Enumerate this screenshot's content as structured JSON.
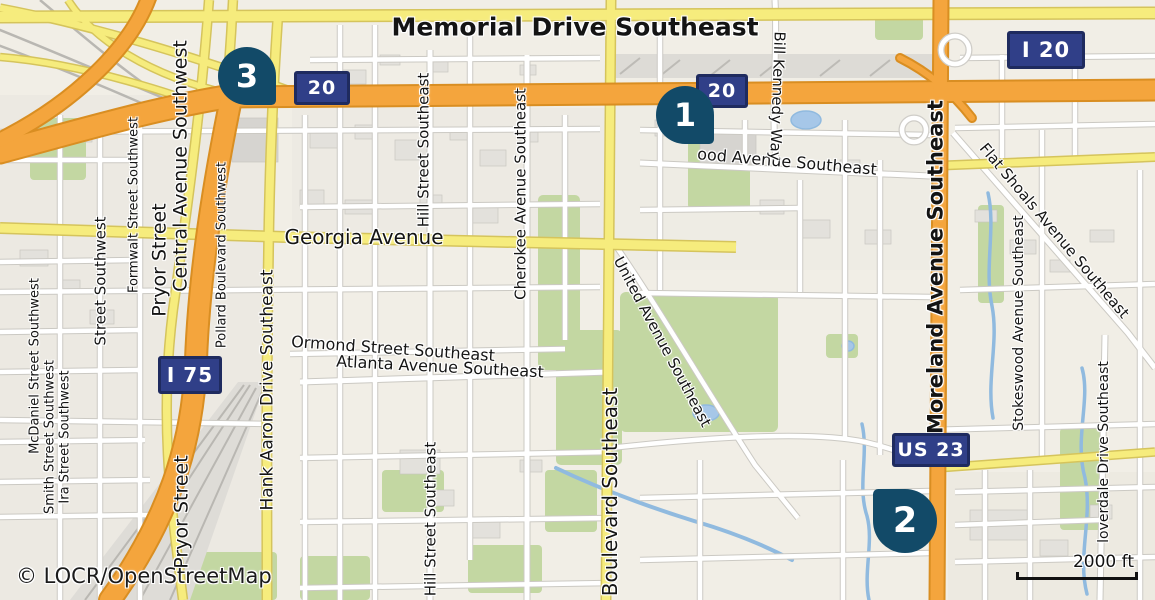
{
  "map": {
    "attribution": "© LOCR/OpenStreetMap",
    "scale_bar": {
      "label": "2000 ft"
    },
    "markers": [
      {
        "number": "1",
        "x": 685,
        "y": 115,
        "size": 58,
        "tail": "br"
      },
      {
        "number": "2",
        "x": 905,
        "y": 521,
        "size": 64,
        "tail": "tl"
      },
      {
        "number": "3",
        "x": 247,
        "y": 76,
        "size": 58,
        "tail": "br"
      }
    ],
    "shields": [
      {
        "text": "20",
        "x": 322,
        "y": 88,
        "w": 56,
        "h": 34,
        "fs": 19
      },
      {
        "text": "20",
        "x": 722,
        "y": 91,
        "w": 52,
        "h": 34,
        "fs": 19
      },
      {
        "text": "I 20",
        "x": 1046,
        "y": 50,
        "w": 78,
        "h": 38,
        "fs": 21
      },
      {
        "text": "I 75",
        "x": 190,
        "y": 375,
        "w": 64,
        "h": 38,
        "fs": 20
      },
      {
        "text": "US 23",
        "x": 931,
        "y": 450,
        "w": 78,
        "h": 34,
        "fs": 19
      }
    ],
    "street_labels": [
      {
        "text": "Memorial Drive Southeast",
        "x": 575,
        "y": 27,
        "size": 25,
        "bold": true,
        "rot": 0
      },
      {
        "text": "Georgia Avenue",
        "x": 364,
        "y": 237,
        "size": 20,
        "bold": false,
        "rot": 0
      },
      {
        "text": "Ormond Street Southeast",
        "x": 393,
        "y": 349,
        "size": 16,
        "bold": false,
        "rot": 4
      },
      {
        "text": "Atlanta Avenue Southeast",
        "x": 440,
        "y": 367,
        "size": 16,
        "bold": false,
        "rot": 3
      },
      {
        "text": "ood Avenue Southeast",
        "x": 787,
        "y": 162,
        "size": 16,
        "bold": false,
        "rot": 5
      },
      {
        "text": "Bill Kennedy Way",
        "x": 777,
        "y": 96,
        "size": 15,
        "bold": false,
        "rot": 92
      },
      {
        "text": "United Avenue Southeast",
        "x": 662,
        "y": 342,
        "size": 15,
        "bold": false,
        "rot": 62
      },
      {
        "text": "Flat Shoals Avenue Southeast",
        "x": 1054,
        "y": 231,
        "size": 15,
        "bold": false,
        "rot": 50
      },
      {
        "text": "Moreland Avenue Southeast",
        "x": 936,
        "y": 267,
        "size": 21,
        "bold": true,
        "rot": -90
      },
      {
        "text": "Stokeswood Avenue Southeast",
        "x": 1019,
        "y": 323,
        "size": 14,
        "bold": false,
        "rot": -90
      },
      {
        "text": "loverdale Drive Southeast",
        "x": 1104,
        "y": 452,
        "size": 14,
        "bold": false,
        "rot": -90
      },
      {
        "text": "Boulevard Southeast",
        "x": 610,
        "y": 492,
        "size": 20,
        "bold": false,
        "rot": -90
      },
      {
        "text": "Hill Street Southeast",
        "x": 424,
        "y": 150,
        "size": 15,
        "bold": false,
        "rot": -90
      },
      {
        "text": "Hill Street Southeast",
        "x": 431,
        "y": 519,
        "size": 15,
        "bold": false,
        "rot": -90
      },
      {
        "text": "Cherokee Avenue Southeast",
        "x": 521,
        "y": 194,
        "size": 15,
        "bold": false,
        "rot": -90
      },
      {
        "text": "Hank Aaron Drive Southeast",
        "x": 268,
        "y": 390,
        "size": 17,
        "bold": false,
        "rot": -90
      },
      {
        "text": "Central Avenue Southwest",
        "x": 181,
        "y": 166,
        "size": 19,
        "bold": false,
        "rot": -90
      },
      {
        "text": "Pryor Street",
        "x": 160,
        "y": 260,
        "size": 19,
        "bold": false,
        "rot": -90
      },
      {
        "text": "Pryor Street",
        "x": 182,
        "y": 512,
        "size": 19,
        "bold": false,
        "rot": -90
      },
      {
        "text": "Formwalt Street Southwest",
        "x": 134,
        "y": 205,
        "size": 13,
        "bold": false,
        "rot": -90
      },
      {
        "text": "Pollard Boulevard Southwest",
        "x": 222,
        "y": 255,
        "size": 13,
        "bold": false,
        "rot": -90
      },
      {
        "text": "McDaniel Street Southwest",
        "x": 35,
        "y": 366,
        "size": 13,
        "bold": false,
        "rot": -90
      },
      {
        "text": "Smith Street Southwest",
        "x": 50,
        "y": 437,
        "size": 13,
        "bold": false,
        "rot": -90
      },
      {
        "text": "Ira Street Southwest",
        "x": 65,
        "y": 437,
        "size": 13,
        "bold": false,
        "rot": -90
      },
      {
        "text": "Street Southwest",
        "x": 101,
        "y": 281,
        "size": 15,
        "bold": false,
        "rot": -90
      }
    ],
    "colors": {
      "marker": "#124A68",
      "shield_fill": "#303F88",
      "shield_border": "#1F2B5F",
      "motorway": "#F4A53D",
      "primary": "#F6EC7D",
      "water": "#A6C7E8",
      "park": "#C3D7A2",
      "label": "#141414"
    }
  }
}
